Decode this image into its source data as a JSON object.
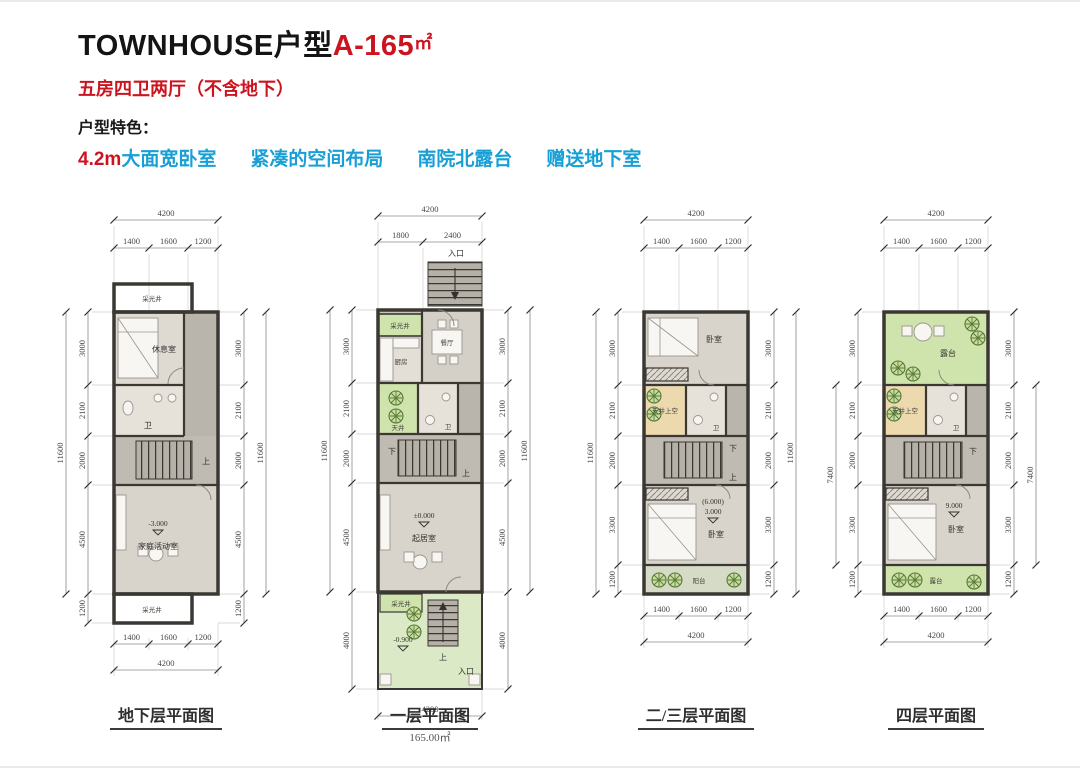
{
  "header": {
    "title_black": "TOWNHOUSE户型",
    "title_red": "A-165",
    "title_unit": "㎡",
    "subtitle": "五房四卫两厅（不含地下）",
    "feature_label": "户型特色：",
    "feature_red": "4.2m",
    "features_teal": [
      "大面宽卧室",
      "紧凑的空间布局",
      "南院北露台",
      "赠送地下室"
    ]
  },
  "colors": {
    "accent_red": "#cc1420",
    "accent_teal": "#189fd6",
    "wall": "#3b3833",
    "lightwell_green": "#cfe3ad",
    "garden_green": "#dce9c6",
    "void_tan": "#ecd9ae"
  },
  "plans": [
    {
      "caption": "地下层平面图",
      "top_total": "4200",
      "top_segs": [
        "1400",
        "1600",
        "1200"
      ],
      "bottom_segs": [
        "1400",
        "1600",
        "1200"
      ],
      "bottom_total": "4200",
      "left_segs": [
        "3000",
        "2100",
        "2000",
        "4500",
        "1200"
      ],
      "left_total": "11600",
      "right_segs": [
        "3000",
        "2100",
        "2000",
        "4500",
        "1200"
      ],
      "right_total": "11600",
      "labels": {
        "lightwell_top": "采光井",
        "restroom": "休息室",
        "bath": "卫",
        "stairs_up": "上",
        "level": "-3.000",
        "family": "家庭活动室",
        "lightwell_bottom": "采光井"
      }
    },
    {
      "caption": "一层平面图",
      "area": "165.00㎡",
      "top_total": "4200",
      "top_segs": [
        "1800",
        "2400"
      ],
      "entry_top": "入口",
      "bottom_total": "4200",
      "left_segs": [
        "3000",
        "2100",
        "2000",
        "4500",
        "4000"
      ],
      "left_total": "11600",
      "right_segs": [
        "3000",
        "2100",
        "2000",
        "4500",
        "4000"
      ],
      "right_total": "11600",
      "labels": {
        "lightwell": "采光井",
        "kitchen": "厨房",
        "dining": "餐厅",
        "patio": "天井",
        "bath": "卫",
        "stairs_down": "下",
        "stairs_up": "上",
        "level": "±0.000",
        "living": "起居室",
        "garden_lightwell": "采光井",
        "garden_level": "-0.900",
        "garden_stairs_up": "上",
        "entry_bottom": "入口"
      }
    },
    {
      "caption": "二/三层平面图",
      "top_total": "4200",
      "top_segs": [
        "1400",
        "1600",
        "1200"
      ],
      "bottom_segs": [
        "1400",
        "1600",
        "1200"
      ],
      "bottom_total": "4200",
      "left_segs": [
        "3000",
        "2100",
        "2000",
        "3300",
        "1200"
      ],
      "left_total": "11600",
      "right_segs": [
        "3000",
        "2100",
        "2000",
        "3300",
        "1200"
      ],
      "right_total": "11600",
      "labels": {
        "bedroom_top": "卧室",
        "void": "天井上空",
        "bath": "卫",
        "stairs_down": "下",
        "stairs_up": "上",
        "level_alt": "(6.000)",
        "level": "3.000",
        "bedroom_bottom": "卧室",
        "balcony": "阳台"
      }
    },
    {
      "caption": "四层平面图",
      "top_total": "4200",
      "top_segs": [
        "1400",
        "1600",
        "1200"
      ],
      "bottom_segs": [
        "1400",
        "1600",
        "1200"
      ],
      "bottom_total": "4200",
      "left_segs": [
        "3000",
        "2100",
        "2000",
        "3300",
        "1200"
      ],
      "left_total": "7400",
      "right_segs": [
        "3000",
        "2100",
        "2000",
        "3300",
        "1200"
      ],
      "right_total": "7400",
      "labels": {
        "terrace_top": "露台",
        "void": "天井上空",
        "bath": "卫",
        "stairs_down": "下",
        "level": "9.000",
        "bedroom": "卧室",
        "terrace_bottom": "露台"
      }
    }
  ]
}
